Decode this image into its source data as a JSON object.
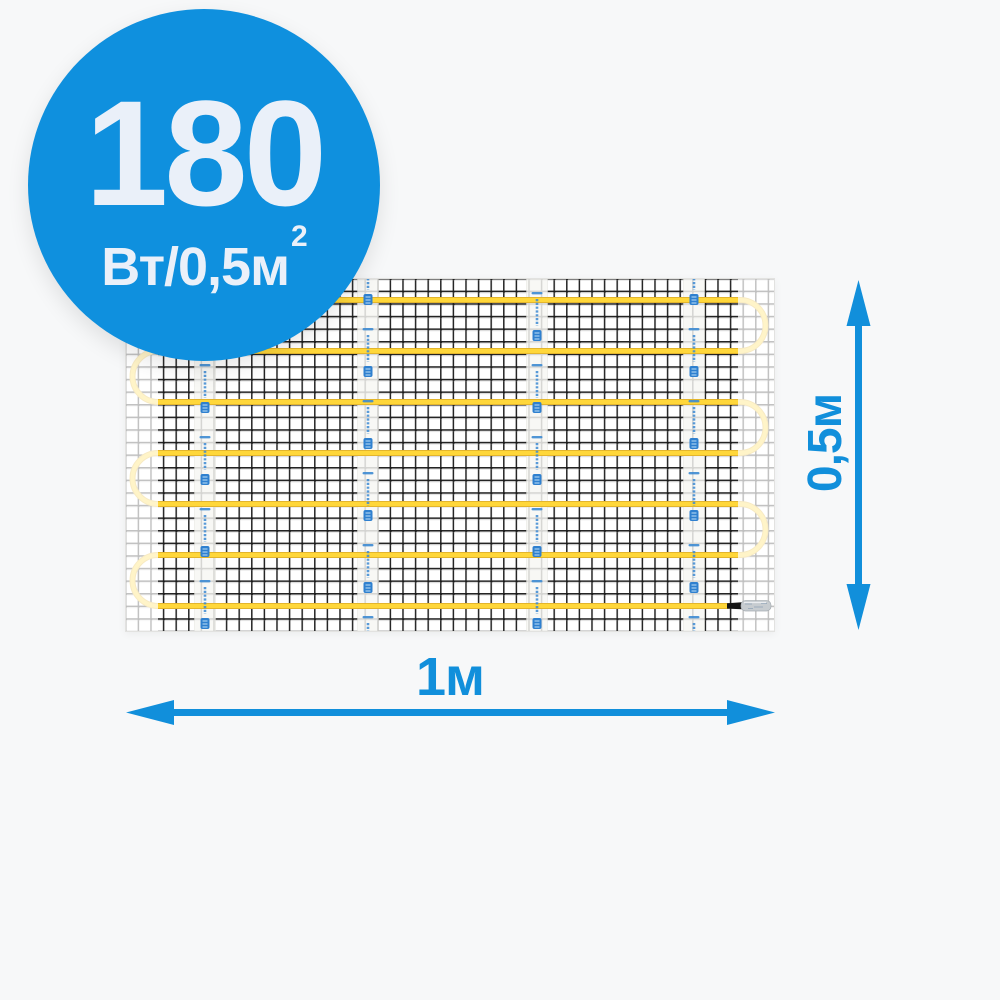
{
  "page": {
    "background": "#f7f8f9",
    "description": "Electric underfloor heating mat product picture with dimensions"
  },
  "badge": {
    "color": "#0f90de",
    "text_color": "#eaf0f9",
    "power_value": "180",
    "power_unit": "Вт/0,5м",
    "power_unit_sup": "2"
  },
  "dimensions": {
    "arrow_color": "#118fdb",
    "width_label": "1м",
    "height_label": "0,5м"
  },
  "mat": {
    "mesh_color": "#242424",
    "cable_color": "#ffd73a",
    "cable_runs": 7,
    "tape_strips": 4,
    "tape_color": "#f7f7f4",
    "tape_mark_color": "#3c8ad2",
    "connector_sleeve_color": "#c7ccd0",
    "cold_lead_color": "#141414"
  }
}
